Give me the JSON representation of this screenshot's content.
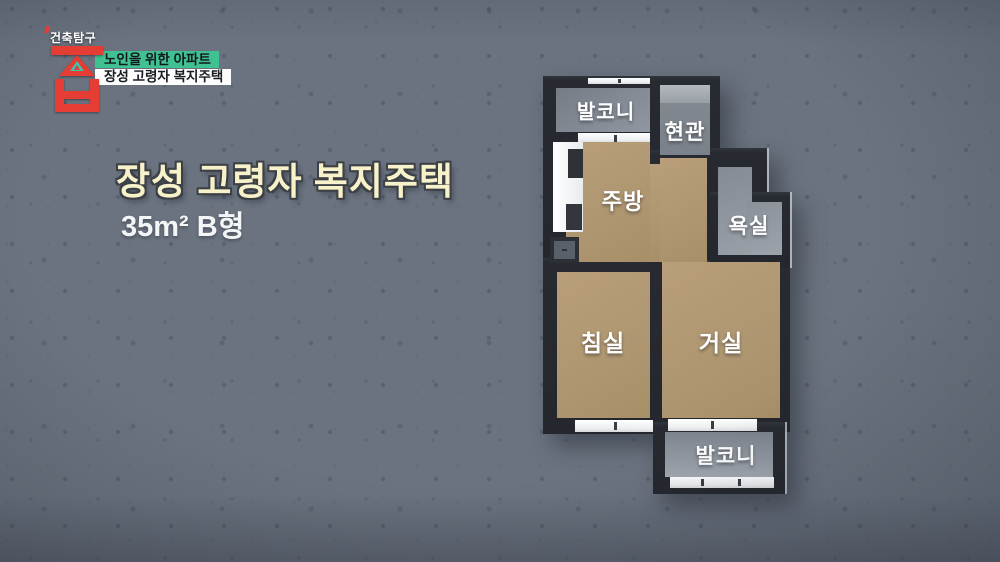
{
  "logo": {
    "show_name": "건축탐구",
    "logo_char": "집"
  },
  "banners": {
    "line1": "노인을 위한 아파트",
    "line2": "장성 고령자 복지주택"
  },
  "title": {
    "main": "장성 고령자 복지주택",
    "sub": "35m² B형"
  },
  "floorplan": {
    "rooms": [
      {
        "id": "balcony-top",
        "label": "발코니"
      },
      {
        "id": "entrance",
        "label": "현관"
      },
      {
        "id": "kitchen",
        "label": "주방"
      },
      {
        "id": "bathroom",
        "label": "욕실"
      },
      {
        "id": "bedroom",
        "label": "침실"
      },
      {
        "id": "living-room",
        "label": "거실"
      },
      {
        "id": "balcony-bottom",
        "label": "발코니"
      }
    ]
  },
  "colors": {
    "background": "#6B7380",
    "accent_green": "#3FC191",
    "logo_red": "#E53C33",
    "logo_teal": "#3CC4AD",
    "title_yellow": "#F8F2CA",
    "wall_dark": "#24272D",
    "floor_tan": "#B29A74",
    "floor_gray": "#868C94"
  }
}
